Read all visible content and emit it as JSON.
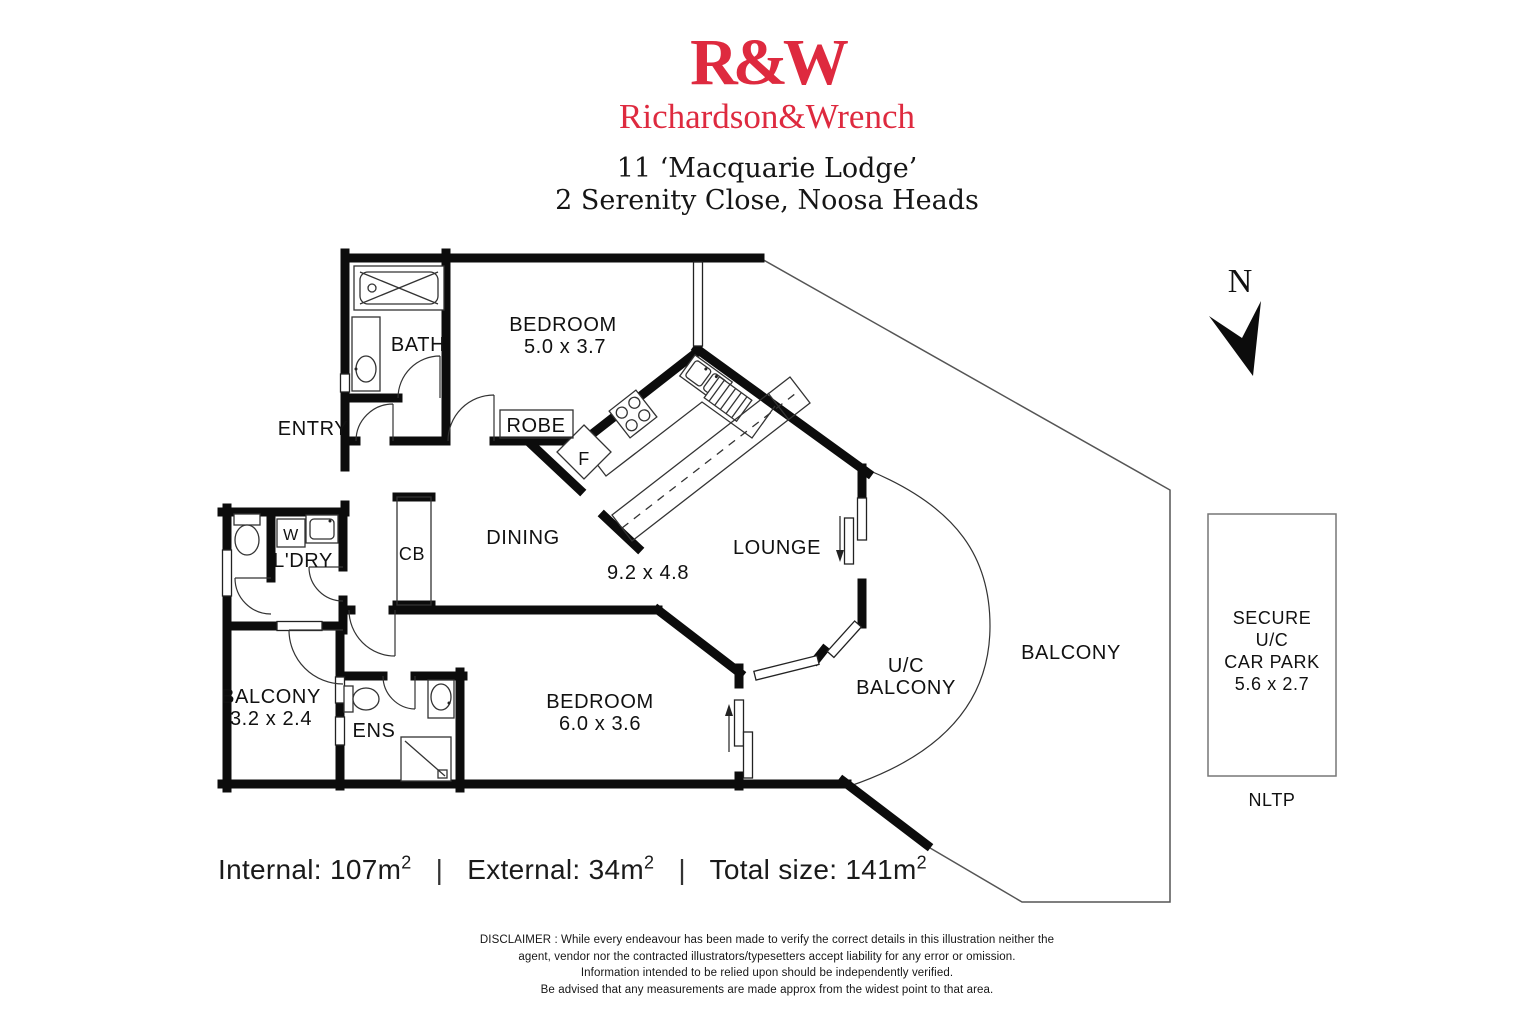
{
  "header": {
    "logo": "R&W",
    "brand": "Richardson&Wrench",
    "address_line1": "11 ‘Macquarie Lodge’",
    "address_line2": "2 Serenity Close, Noosa Heads"
  },
  "compass": {
    "label": "N"
  },
  "rooms": {
    "bath": "BATH",
    "bedroom1_name": "BEDROOM",
    "bedroom1_dims": "5.0 x 3.7",
    "entry": "ENTRY",
    "robe": "ROBE",
    "fridge": "F",
    "dining": "DINING",
    "living_dims": "9.2 x 4.8",
    "lounge": "LOUNGE",
    "cupboard": "CB",
    "washer": "W",
    "laundry": "L'DRY",
    "balcony_left_name": "BALCONY",
    "balcony_left_dims": "3.2 x 2.4",
    "ensuite": "ENS",
    "bedroom2_name": "BEDROOM",
    "bedroom2_dims": "6.0 x 3.6",
    "uc_balcony_line1": "U/C",
    "uc_balcony_line2": "BALCONY",
    "balcony_right": "BALCONY"
  },
  "carpark": {
    "line1": "SECURE",
    "line2": "U/C",
    "line3": "CAR PARK",
    "line4": "5.6 x 2.7",
    "caption": "NLTP"
  },
  "areas": {
    "internal_label": "Internal:",
    "internal_value": "107m",
    "external_label": "External:",
    "external_value": "34m",
    "total_label": "Total size:",
    "total_value": "141m",
    "sup": "2",
    "separator": "|"
  },
  "disclaimer": {
    "line1": "DISCLAIMER : While every endeavour has been made to verify the correct details in this illustration neither the",
    "line2": "agent, vendor nor the contracted illustrators/typesetters accept liability for any error or omission.",
    "line3": "Information intended to be relied upon should be independently verified.",
    "line4": "Be advised that any measurements are made approx from the widest point to that area."
  },
  "colors": {
    "brand_red": "#DE2A3F",
    "wall": "#0c0c0c"
  }
}
